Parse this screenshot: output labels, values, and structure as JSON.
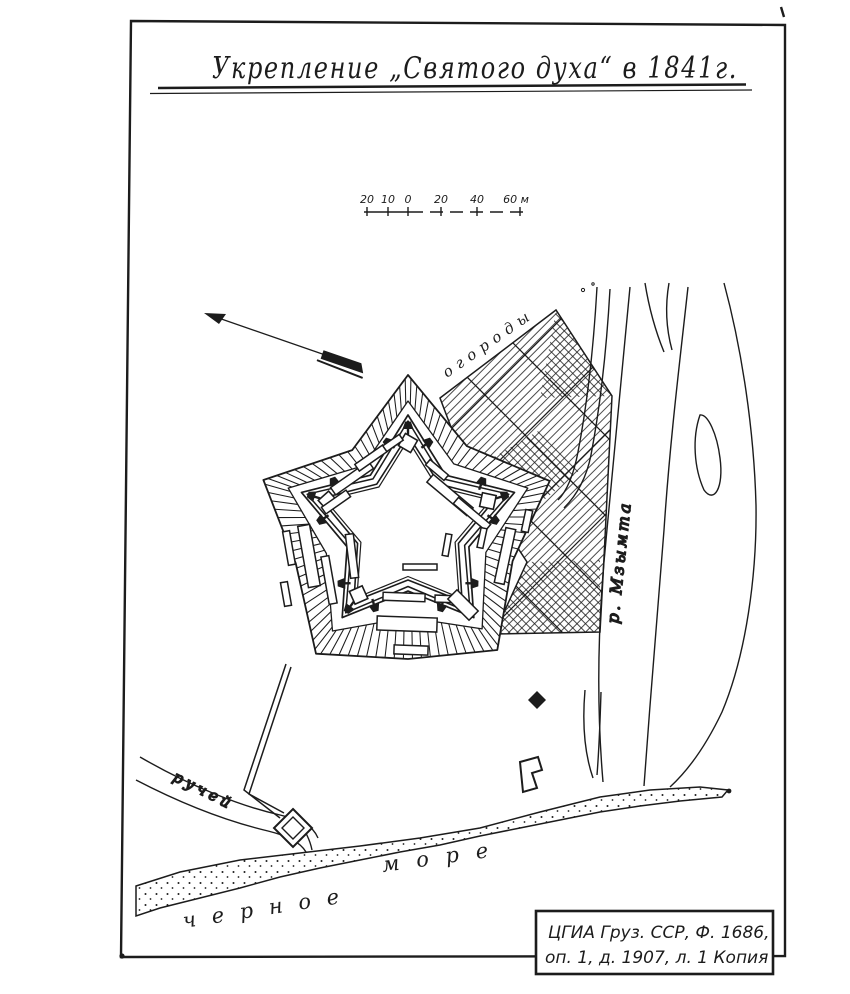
{
  "title": "Укрепление „Святого духа“ в 1841г.",
  "scale_bar": {
    "labels": [
      "20",
      "10",
      "0",
      "20",
      "40",
      "60 м"
    ]
  },
  "map_labels": {
    "gardens": "огороды",
    "river": "р. Мзымта",
    "stream": "ручей",
    "sea_word1": "черное",
    "sea_word2": "море"
  },
  "stamp": {
    "line1": "ЦГИА  Груз. ССР, Ф. 1686,",
    "line2": "оп. 1, д. 1907, л. 1  Копия"
  },
  "ink_color": "#1c1c1c",
  "paper_color": "#ffffff"
}
